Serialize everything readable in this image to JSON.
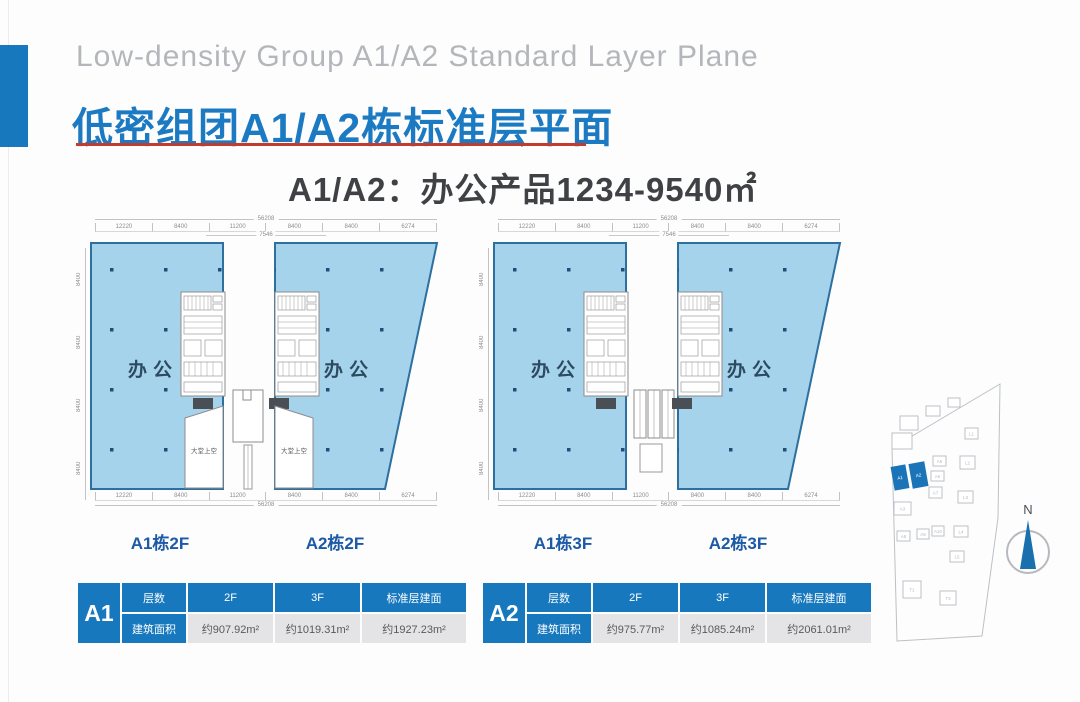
{
  "header": {
    "title_en": "Low-density Group A1/A2 Standard Layer Plane",
    "title_zh": "低密组团A1/A2栋标准层平面",
    "subtitle": "A1/A2：办公产品1234-9540㎡"
  },
  "plan_common": {
    "room_label": "办公",
    "void_label": "大堂上空",
    "dims": {
      "top_total": "56208",
      "top_segments": [
        "12220",
        "8400",
        "11200",
        "8400",
        "8400",
        "6274"
      ],
      "mid": "7546",
      "side_segments": [
        "8400",
        "8400",
        "8400",
        "8400"
      ],
      "bottom_segments": [
        "12220",
        "8400",
        "11200",
        "8400",
        "8400",
        "6274"
      ],
      "bottom_total": "56208"
    }
  },
  "plans": [
    {
      "left_label": "A1栋2F",
      "right_label": "A2栋2F"
    },
    {
      "left_label": "A1栋3F",
      "right_label": "A2栋3F"
    }
  ],
  "tables": [
    {
      "building": "A1",
      "headers": [
        "层数",
        "2F",
        "3F",
        "标准层建面"
      ],
      "row_label": "建筑面积",
      "values": [
        "约907.92m²",
        "约1019.31m²",
        "约1927.23m²"
      ]
    },
    {
      "building": "A2",
      "headers": [
        "层数",
        "2F",
        "3F",
        "标准层建面"
      ],
      "row_label": "建筑面积",
      "values": [
        "约975.77m²",
        "约1085.24m²",
        "约2061.01m²"
      ]
    }
  ],
  "site_map": {
    "compass_label": "N",
    "outline": "130,6 22,70 27,263 112,258 128,140",
    "colors": {
      "highlight": "#1b74b8",
      "outline": "#bcc0c6"
    },
    "buildings": [
      {
        "x": 23,
        "y": 88,
        "w": 14,
        "h": 23,
        "label": "A1",
        "hl": true,
        "rot": -10
      },
      {
        "x": 41,
        "y": 85,
        "w": 15,
        "h": 24,
        "label": "A2",
        "hl": true,
        "rot": -10
      },
      {
        "x": 63,
        "y": 78,
        "w": 13,
        "h": 10,
        "label": "A5"
      },
      {
        "x": 61,
        "y": 93,
        "w": 13,
        "h": 10,
        "label": "A6"
      },
      {
        "x": 59,
        "y": 109,
        "w": 13,
        "h": 11,
        "label": "A7"
      },
      {
        "x": 24,
        "y": 124,
        "w": 17,
        "h": 13,
        "label": "A3"
      },
      {
        "x": 27,
        "y": 153,
        "w": 13,
        "h": 10,
        "label": "A8"
      },
      {
        "x": 47,
        "y": 151,
        "w": 12,
        "h": 10,
        "label": "A9"
      },
      {
        "x": 62,
        "y": 148,
        "w": 12,
        "h": 10,
        "label": "A10"
      },
      {
        "x": 95,
        "y": 50,
        "w": 13,
        "h": 11,
        "label": "L1"
      },
      {
        "x": 90,
        "y": 78,
        "w": 15,
        "h": 13,
        "label": "L2"
      },
      {
        "x": 88,
        "y": 113,
        "w": 15,
        "h": 12,
        "label": "L3"
      },
      {
        "x": 84,
        "y": 148,
        "w": 14,
        "h": 11,
        "label": "L4"
      },
      {
        "x": 80,
        "y": 173,
        "w": 14,
        "h": 11,
        "label": "L5"
      },
      {
        "x": 33,
        "y": 203,
        "w": 18,
        "h": 17,
        "label": "T1"
      },
      {
        "x": 70,
        "y": 213,
        "w": 16,
        "h": 14,
        "label": "T3"
      },
      {
        "x": 30,
        "y": 38,
        "w": 18,
        "h": 14
      },
      {
        "x": 56,
        "y": 28,
        "w": 14,
        "h": 10
      },
      {
        "x": 78,
        "y": 20,
        "w": 12,
        "h": 9
      },
      {
        "x": 22,
        "y": 55,
        "w": 20,
        "h": 16
      }
    ]
  },
  "colors": {
    "accent": "#1878be",
    "plan_fill": "#a5d3ec",
    "plan_stroke": "#2d6f9e",
    "underline": "#c23b2e"
  }
}
